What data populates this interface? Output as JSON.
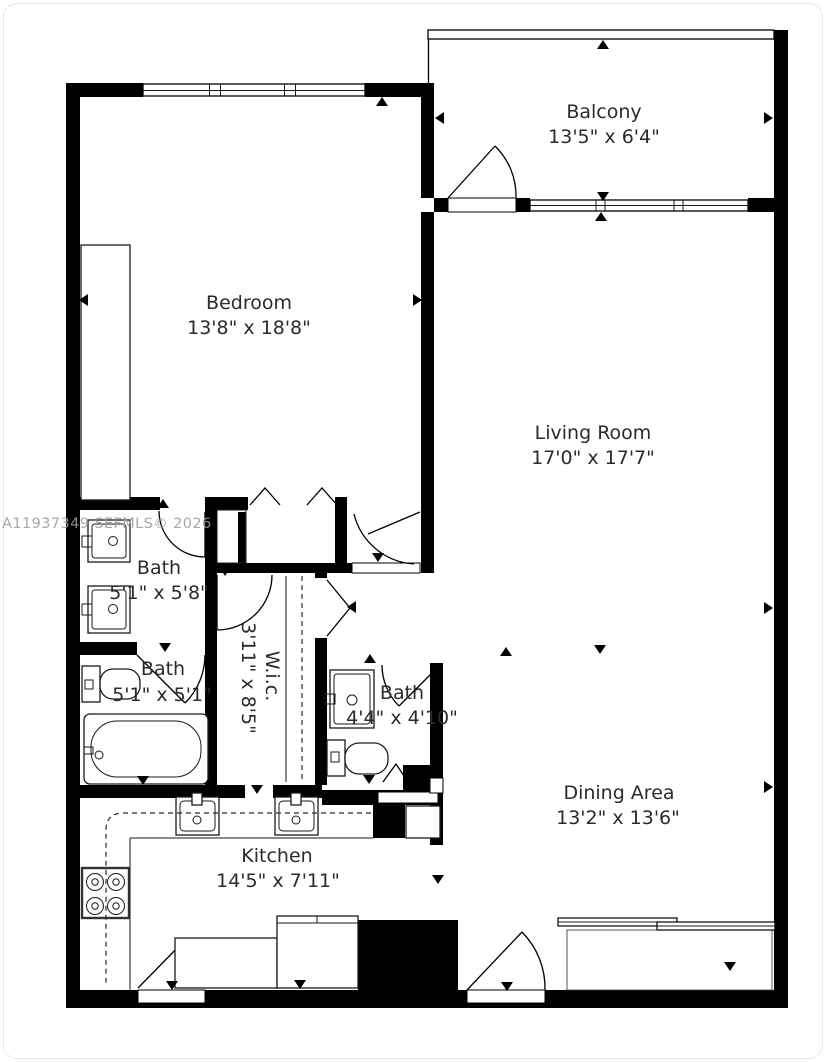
{
  "watermark": "A11937349 SEFMLS© 2026",
  "rooms": {
    "balcony": {
      "name": "Balcony",
      "dims": "13'5\" x 6'4\""
    },
    "bedroom": {
      "name": "Bedroom",
      "dims": "13'8\" x 18'8\""
    },
    "living": {
      "name": "Living Room",
      "dims": "17'0\" x 17'7\""
    },
    "dining": {
      "name": "Dining Area",
      "dims": "13'2\" x 13'6\""
    },
    "kitchen": {
      "name": "Kitchen",
      "dims": "14'5\" x 7'11\""
    },
    "bath1": {
      "name": "Bath",
      "dims": "5'1\" x 5'8\""
    },
    "bath2": {
      "name": "Bath",
      "dims": "5'1\" x 5'1\""
    },
    "bath3": {
      "name": "Bath",
      "dims": "4'4\" x 4'10\""
    },
    "wic": {
      "name": "W.i.c.",
      "dims": "3'11\" x 8'5\""
    }
  },
  "colors": {
    "wall": "#000000",
    "text": "#2b2b2b",
    "watermark": "#9aa0a5",
    "card_border": "#e7e7e7"
  }
}
